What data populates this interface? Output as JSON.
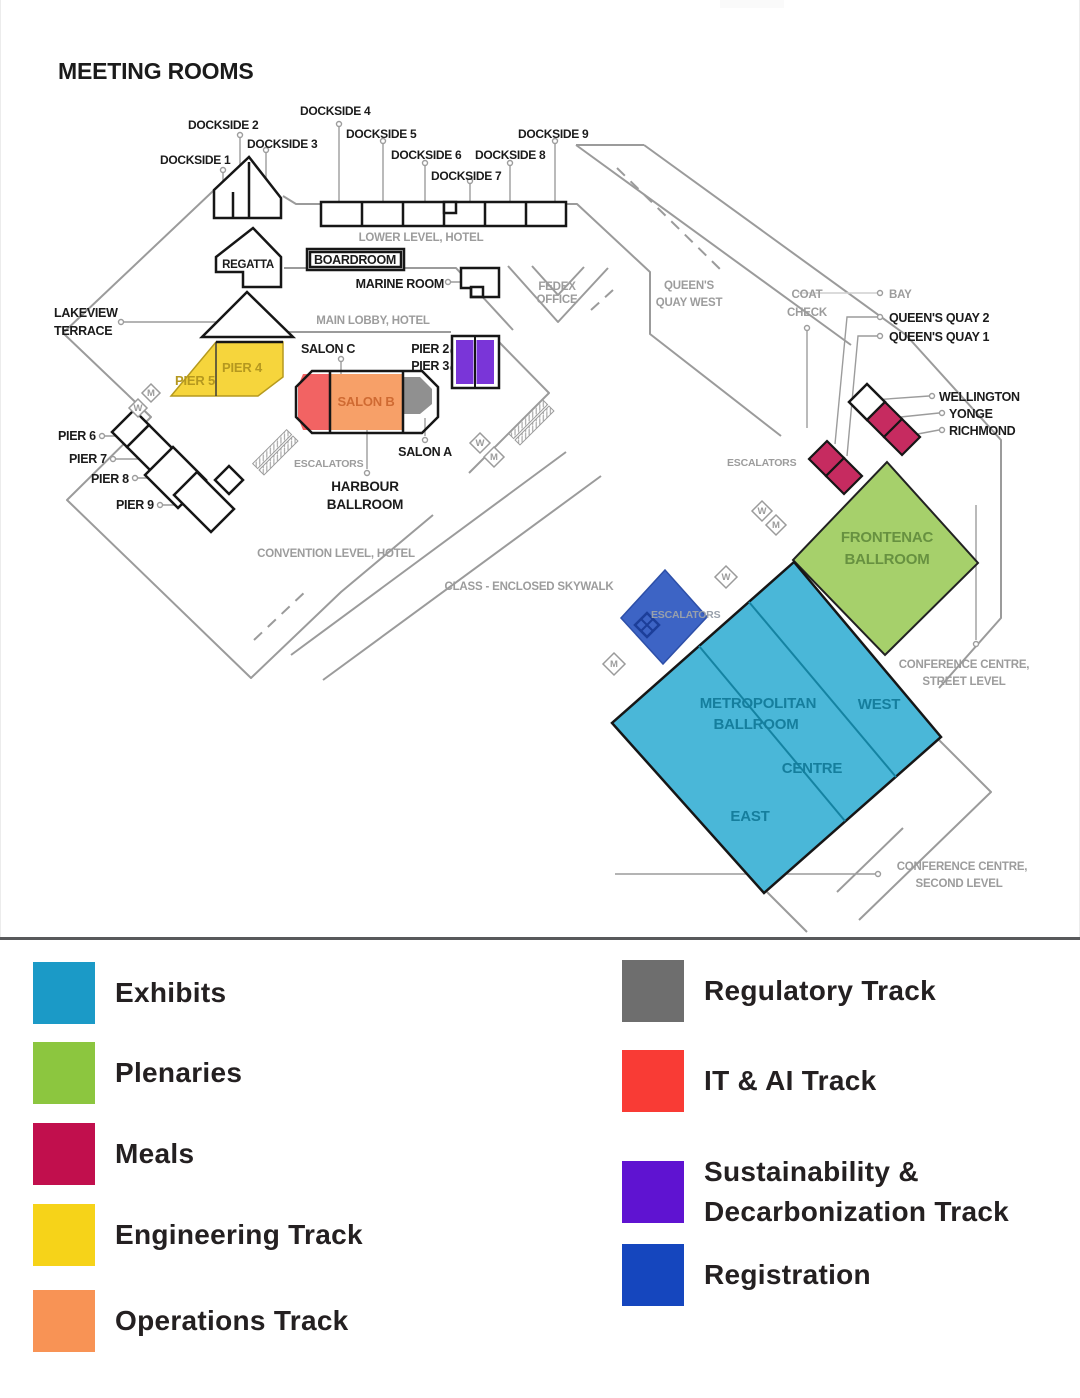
{
  "title": "MEETING ROOMS",
  "map_colors": {
    "exhibits": "#4AB7D8",
    "plenaries": "#A6D06B",
    "meals": "#C62B60",
    "engineering": "#F6D53C",
    "operations": "#F7A068",
    "regulatory": "#909090",
    "it_ai": "#F26363",
    "sustainability": "#7A35D8",
    "registration": "#3D64C5"
  },
  "map": {
    "rooms": {
      "dockside1": "DOCKSIDE 1",
      "dockside2": "DOCKSIDE 2",
      "dockside3": "DOCKSIDE 3",
      "dockside4": "DOCKSIDE 4",
      "dockside5": "DOCKSIDE 5",
      "dockside6": "DOCKSIDE 6",
      "dockside7": "DOCKSIDE 7",
      "dockside8": "DOCKSIDE 8",
      "dockside9": "DOCKSIDE 9",
      "regatta": "REGATTA",
      "boardroom": "BOARDROOM",
      "marine": "MARINE ROOM",
      "lakeview1": "LAKEVIEW",
      "lakeview2": "TERRACE",
      "pier2": "PIER 2",
      "pier3": "PIER 3",
      "pier4": "PIER 4",
      "pier5": "PIER 5",
      "salon_a": "SALON A",
      "salon_b": "SALON B",
      "salon_c": "SALON C",
      "harbour1": "HARBOUR",
      "harbour2": "BALLROOM",
      "pier6": "PIER 6",
      "pier7": "PIER 7",
      "pier8": "PIER 8",
      "pier9": "PIER 9",
      "wellington": "WELLINGTON",
      "yonge": "YONGE",
      "richmond": "RICHMOND",
      "queens_quay2": "QUEEN'S QUAY 2",
      "queens_quay1": "QUEEN'S QUAY 1",
      "frontenac1": "FRONTENAC",
      "frontenac2": "BALLROOM",
      "metropolitan1": "METROPOLITAN",
      "metropolitan2": "BALLROOM",
      "west": "WEST",
      "centre": "CENTRE",
      "east": "EAST"
    },
    "areas": {
      "lower_level": "LOWER LEVEL, HOTEL",
      "main_lobby": "MAIN LOBBY, HOTEL",
      "convention_level": "CONVENTION LEVEL, HOTEL",
      "skywalk": "CLASS - ENCLOSED SKYWALK",
      "fedex1": "FEDEX",
      "fedex2": "OFFICE",
      "qqw1": "QUEEN'S",
      "qqw2": "QUAY WEST",
      "coat1": "COAT",
      "coat2": "CHECK",
      "bay": "BAY",
      "escalators": "ESCALATORS",
      "street1": "CONFERENCE CENTRE,",
      "street2": "STREET LEVEL",
      "second1": "CONFERENCE CENTRE,",
      "second2": "SECOND LEVEL",
      "w": "W",
      "m": "M"
    }
  },
  "legend": {
    "left": [
      {
        "label": "Exhibits",
        "color": "#1B9AC7"
      },
      {
        "label": "Plenaries",
        "color": "#8CC63F"
      },
      {
        "label": "Meals",
        "color": "#C10F4D"
      },
      {
        "label": "Engineering Track",
        "color": "#F6D319"
      },
      {
        "label": "Operations Track",
        "color": "#F89355"
      }
    ],
    "right": [
      {
        "label": "Regulatory Track",
        "color": "#6E6E6E"
      },
      {
        "label": "IT & AI Track",
        "color": "#F93B35"
      },
      {
        "label": "Sustainability & Decarbonization Track",
        "color": "#5F13D1"
      },
      {
        "label": "Registration",
        "color": "#1546BE"
      }
    ]
  }
}
